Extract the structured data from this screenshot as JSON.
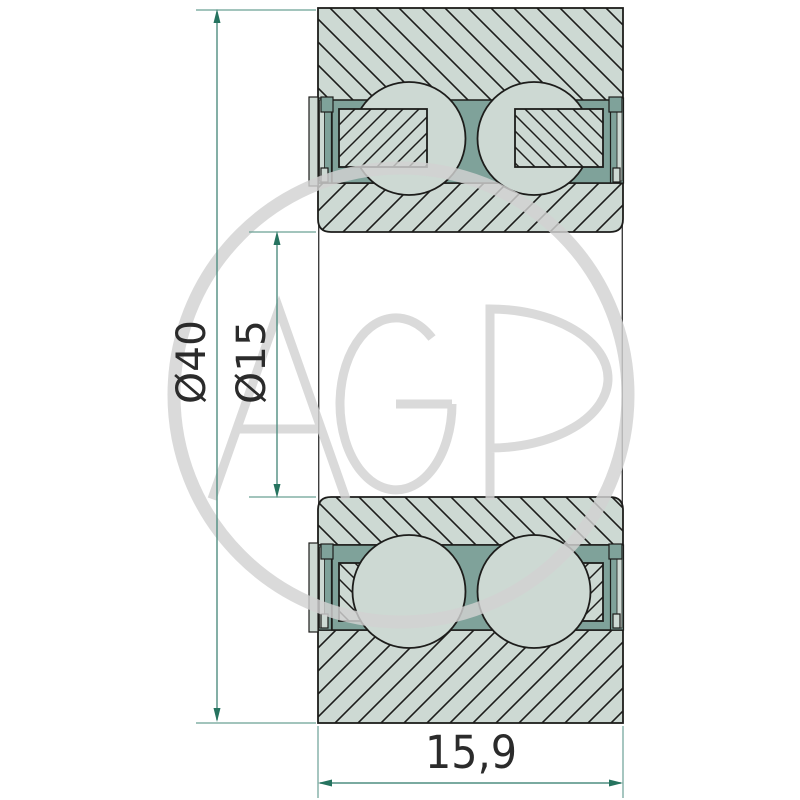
{
  "drawing": {
    "type": "bearing-cross-section-technical-drawing",
    "dimensions": {
      "outer_diameter_label": "Ø40",
      "bore_diameter_label": "Ø15",
      "width_label": "15,9"
    },
    "watermark": {
      "text": "AGP"
    },
    "colors": {
      "background": "#ffffff",
      "body_fill": "#cdd9d3",
      "cage_fill": "#7fa29a",
      "outline": "#1d1d1b",
      "dimension_line": "#4f8d80",
      "extension_line": "#6aa095",
      "arrow": "#26735f",
      "label_text": "#2b2b2b",
      "watermark_gray": "#d2d2d2"
    }
  }
}
